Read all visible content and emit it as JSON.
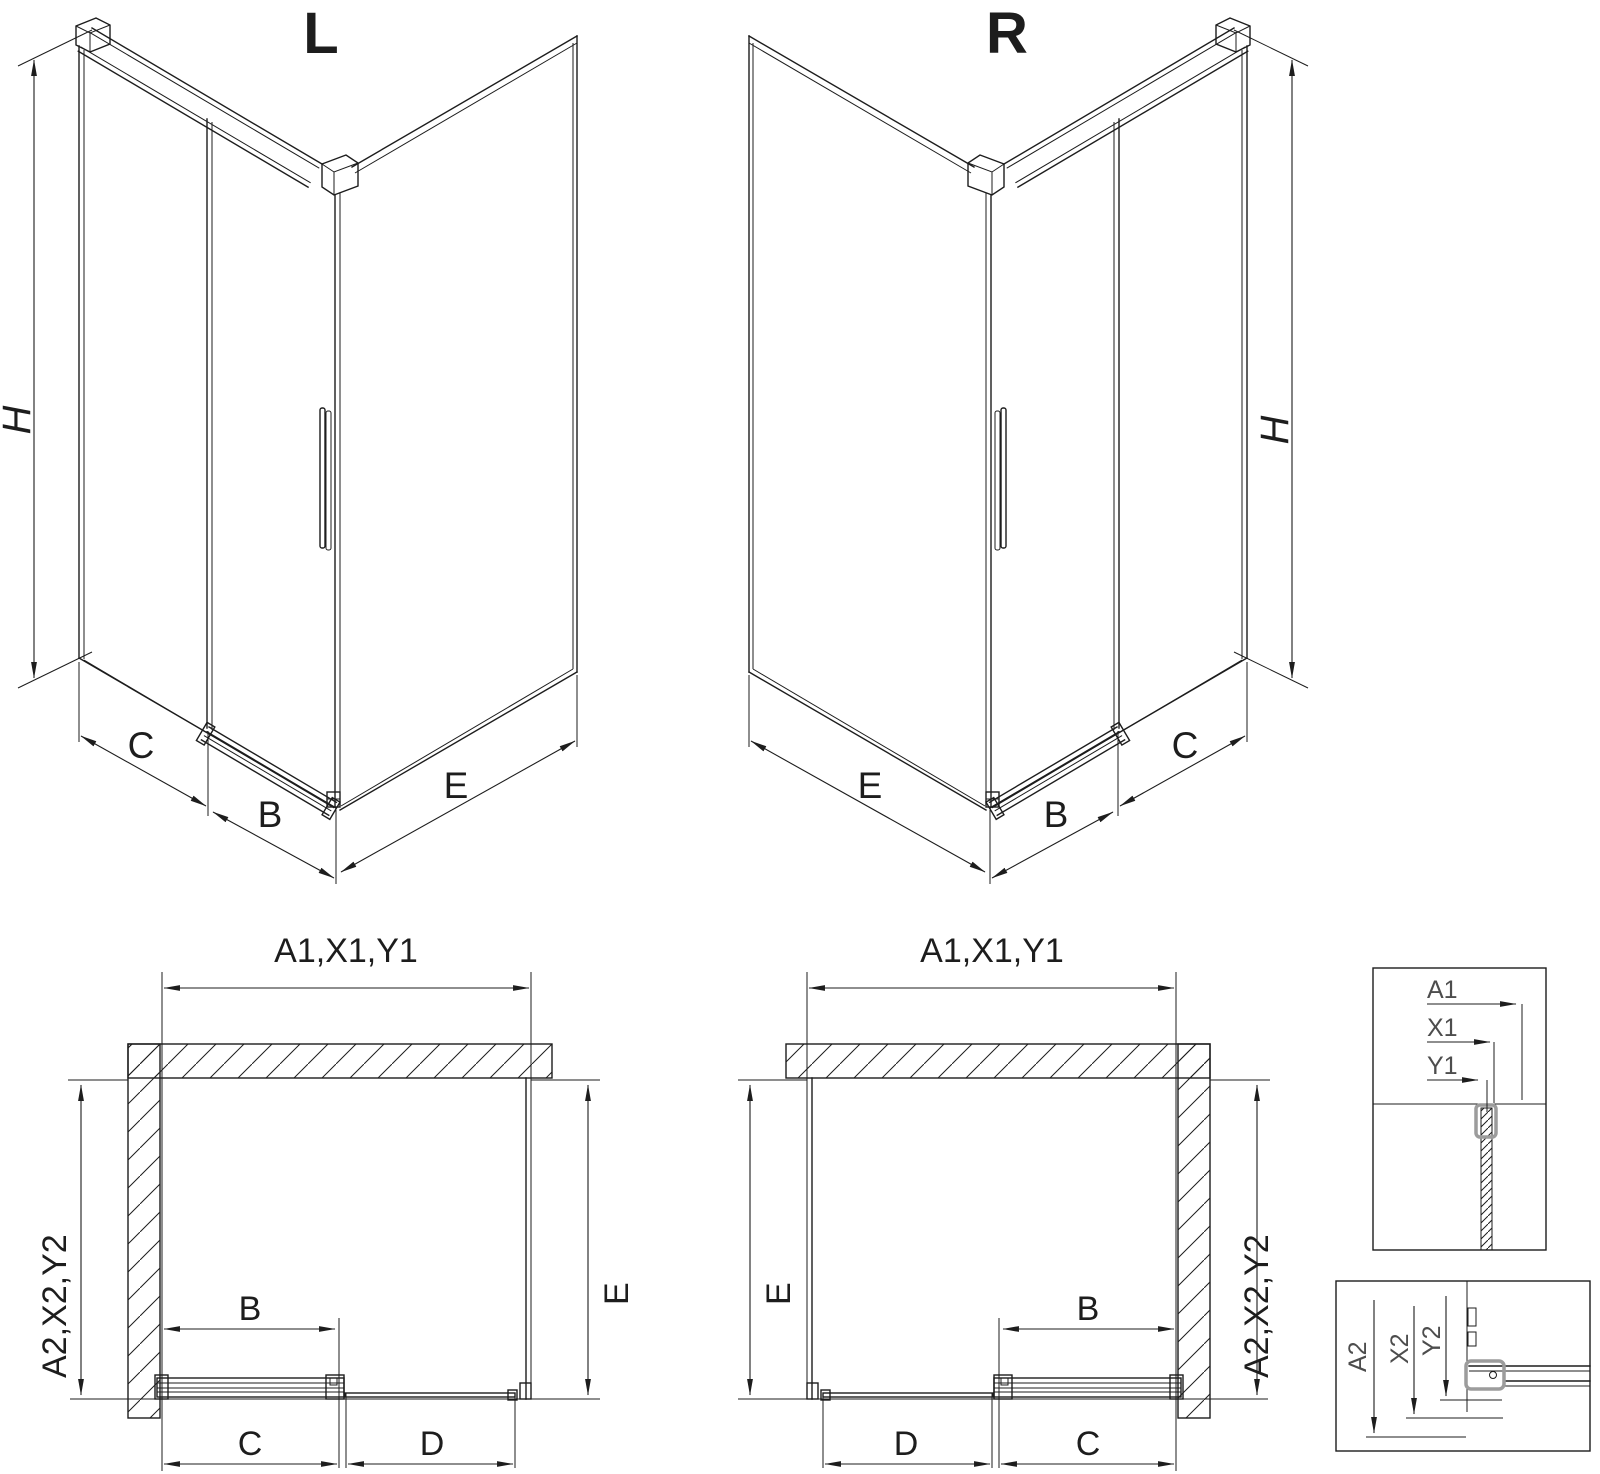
{
  "drawing": {
    "iso_left": {
      "title": "L",
      "dim_h": "H",
      "dim_c": "C",
      "dim_b": "B",
      "dim_e": "E"
    },
    "iso_right": {
      "title": "R",
      "dim_h": "H",
      "dim_c": "C",
      "dim_b": "B",
      "dim_e": "E"
    },
    "plan_left": {
      "width_label": "A1,X1,Y1",
      "depth_label": "A2,X2,Y2",
      "dim_b": "B",
      "dim_c": "C",
      "dim_d": "D",
      "dim_e": "E"
    },
    "plan_right": {
      "width_label": "A1,X1,Y1",
      "depth_label": "A2,X2,Y2",
      "dim_b": "B",
      "dim_c": "C",
      "dim_d": "D",
      "dim_e": "E"
    },
    "detail_top": {
      "a1": "A1",
      "x1": "X1",
      "y1": "Y1"
    },
    "detail_bottom": {
      "a2": "A2",
      "x2": "X2",
      "y2": "Y2"
    },
    "colors": {
      "line": "#1d1d1d",
      "detail_label": "#4d4d4d",
      "clamp_gray": "#9c9c9c",
      "background": "#ffffff"
    }
  }
}
